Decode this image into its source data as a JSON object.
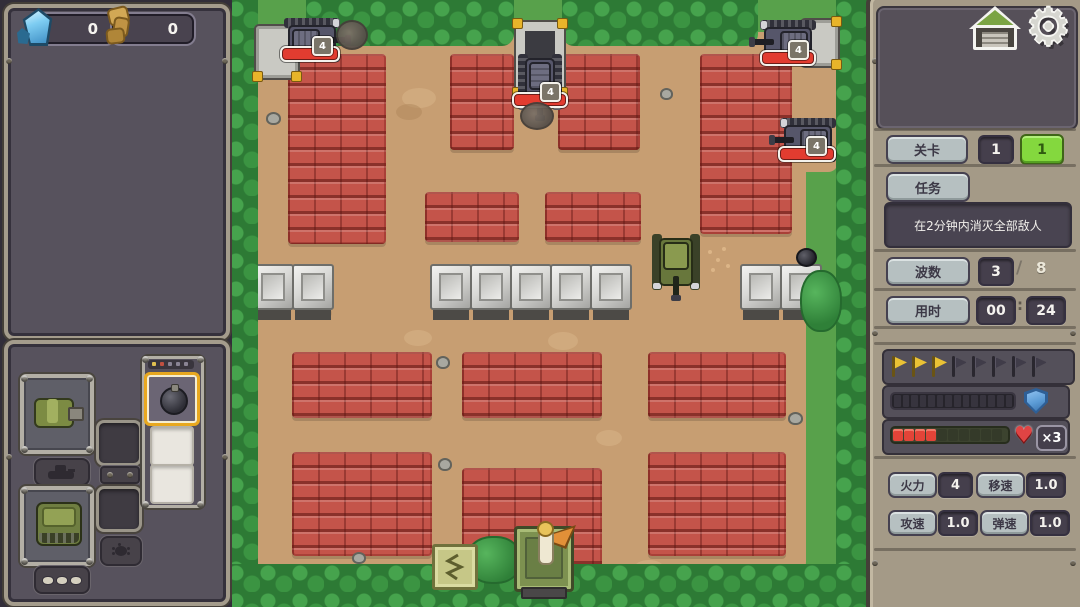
{
  "hud": {
    "resources": [
      {
        "icon": "crystal-icon",
        "value": "0"
      },
      {
        "icon": "scrap-icon",
        "value": "0"
      }
    ]
  },
  "icons": {
    "gear": "⚙",
    "heart": "♥"
  },
  "right_panel": {
    "level": {
      "label": "关卡",
      "stage": "1",
      "substage": "1"
    },
    "mission": {
      "label": "任务",
      "text": "在2分钟内消灭全部敌人"
    },
    "wave": {
      "label": "波数",
      "current": "3",
      "sep": "/",
      "total": "8"
    },
    "time": {
      "label": "用时",
      "min": "00",
      "sep": ":",
      "sec": "24"
    },
    "wave_flags": {
      "total": 8,
      "completed": 3
    },
    "shield_bar": {
      "segments": 14,
      "filled": 0,
      "color": "#5b9bd5"
    },
    "health_bar": {
      "segments": 10,
      "filled": 4,
      "lives": "×3",
      "color": "#e24438"
    },
    "stats": [
      {
        "label": "火力",
        "value": "4"
      },
      {
        "label": "移速",
        "value": "1.0"
      },
      {
        "label": "攻速",
        "value": "1.0"
      },
      {
        "label": "弹速",
        "value": "1.0"
      }
    ]
  },
  "field": {
    "enemies": [
      {
        "badge": "4"
      },
      {
        "badge": "4"
      },
      {
        "badge": "4"
      },
      {
        "badge": "4"
      }
    ]
  },
  "colors": {
    "accent_green": "#84d83e",
    "brick": "#c4544a",
    "flag_done": "#eac235",
    "panel_frame": "#a49c8c"
  }
}
